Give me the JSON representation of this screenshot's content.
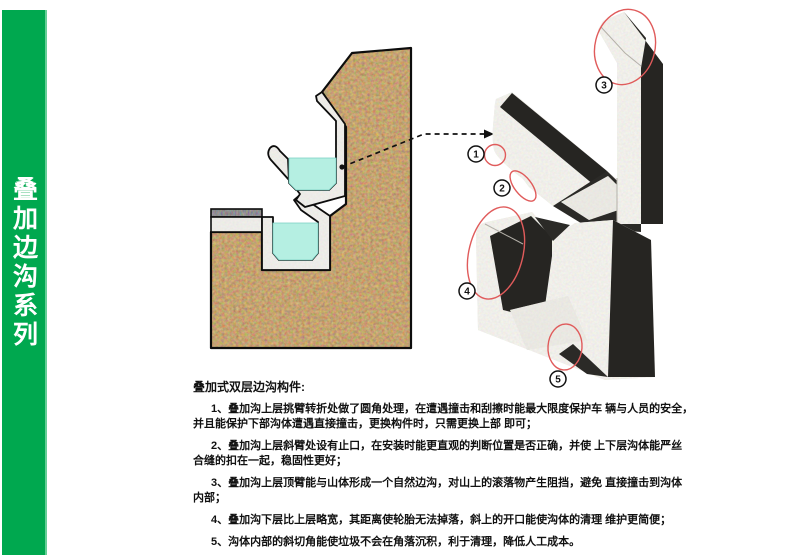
{
  "sidebar": {
    "title": "叠加边沟系列",
    "bg_color": "#00a84f",
    "text_color": "#ffffff"
  },
  "diagram": {
    "water_color": "#b5efe2",
    "soil_color": "#7a4a20",
    "concrete_color": "#e2e0da",
    "shadow_color": "#262522",
    "highlight_color": "#e05b5b",
    "callouts": [
      {
        "label": "1"
      },
      {
        "label": "2"
      },
      {
        "label": "3"
      },
      {
        "label": "4"
      },
      {
        "label": "5"
      }
    ]
  },
  "description": {
    "title": "叠加式双层边沟构件:",
    "points": [
      {
        "lines": [
          "1、叠加沟上层挑臂转折处做了圆角处理，在遭遇撞击和刮擦时能最大限度保护车 辆与人员的安全，",
          "并且能保护下部沟体遭遇直接撞击，更换构件时，只需更换上部 即可；"
        ]
      },
      {
        "lines": [
          "2、叠加沟上层斜臂处设有止口，在安装时能更直观的判断位置是否正确，并使 上下层沟体能严丝",
          "合缝的扣在一起，稳固性更好；"
        ]
      },
      {
        "lines": [
          "3、叠加沟上层顶臂能与山体形成一个自然边沟，对山上的滚落物产生阻挡，避免 直接撞击到沟体",
          "内部；"
        ]
      },
      {
        "lines": [
          "4、叠加沟下层比上层略宽，其距离使轮胎无法掉落，斜上的开口能使沟体的清理 维护更简便；"
        ]
      },
      {
        "lines": [
          "5、沟体内部的斜切角能使垃圾不会在角落沉积，利于清理，降低人工成本。"
        ]
      }
    ]
  }
}
